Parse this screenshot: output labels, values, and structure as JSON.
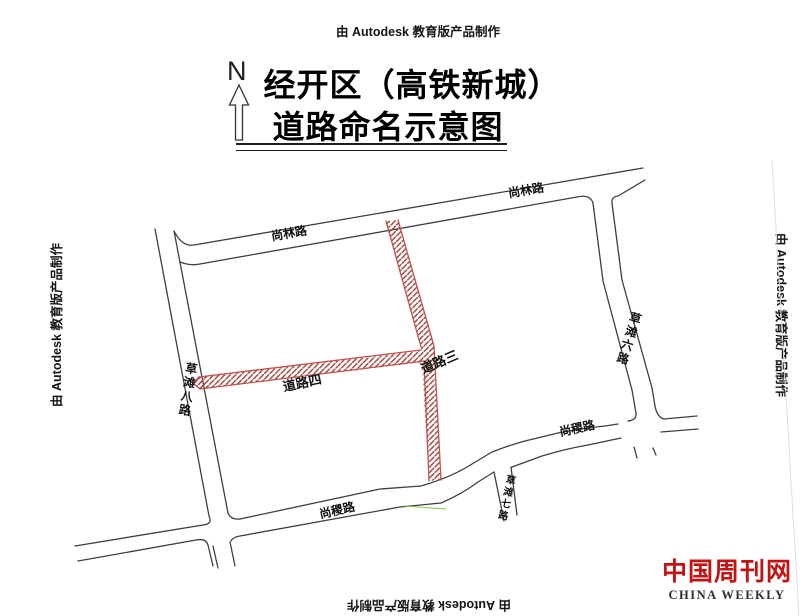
{
  "watermark": {
    "text": "由 Autodesk 教育版产品制作"
  },
  "compass": {
    "label": "N"
  },
  "title": {
    "line1": "经开区（高铁新城）",
    "line2": "道路命名示意图"
  },
  "map": {
    "road_labels": {
      "shanglin_1": "尚林路",
      "shanglin_2": "尚林路",
      "caotan_ba": "草滩八路",
      "caotan_liu": "草滩六路",
      "caotan_qi": "草滩七路",
      "shangji_1": "尚稷路",
      "shangji_2": "尚稷路",
      "daolu_si": "道路四",
      "daolu_san": "道路三"
    },
    "colors": {
      "existing_road_line": "#3f3f3f",
      "named_road_border": "#c0504d",
      "named_road_hatch": "#a34a42"
    }
  },
  "logo": {
    "cn": "中国周刊网",
    "en": "CHINA WEEKLY",
    "color": "#c31212"
  }
}
